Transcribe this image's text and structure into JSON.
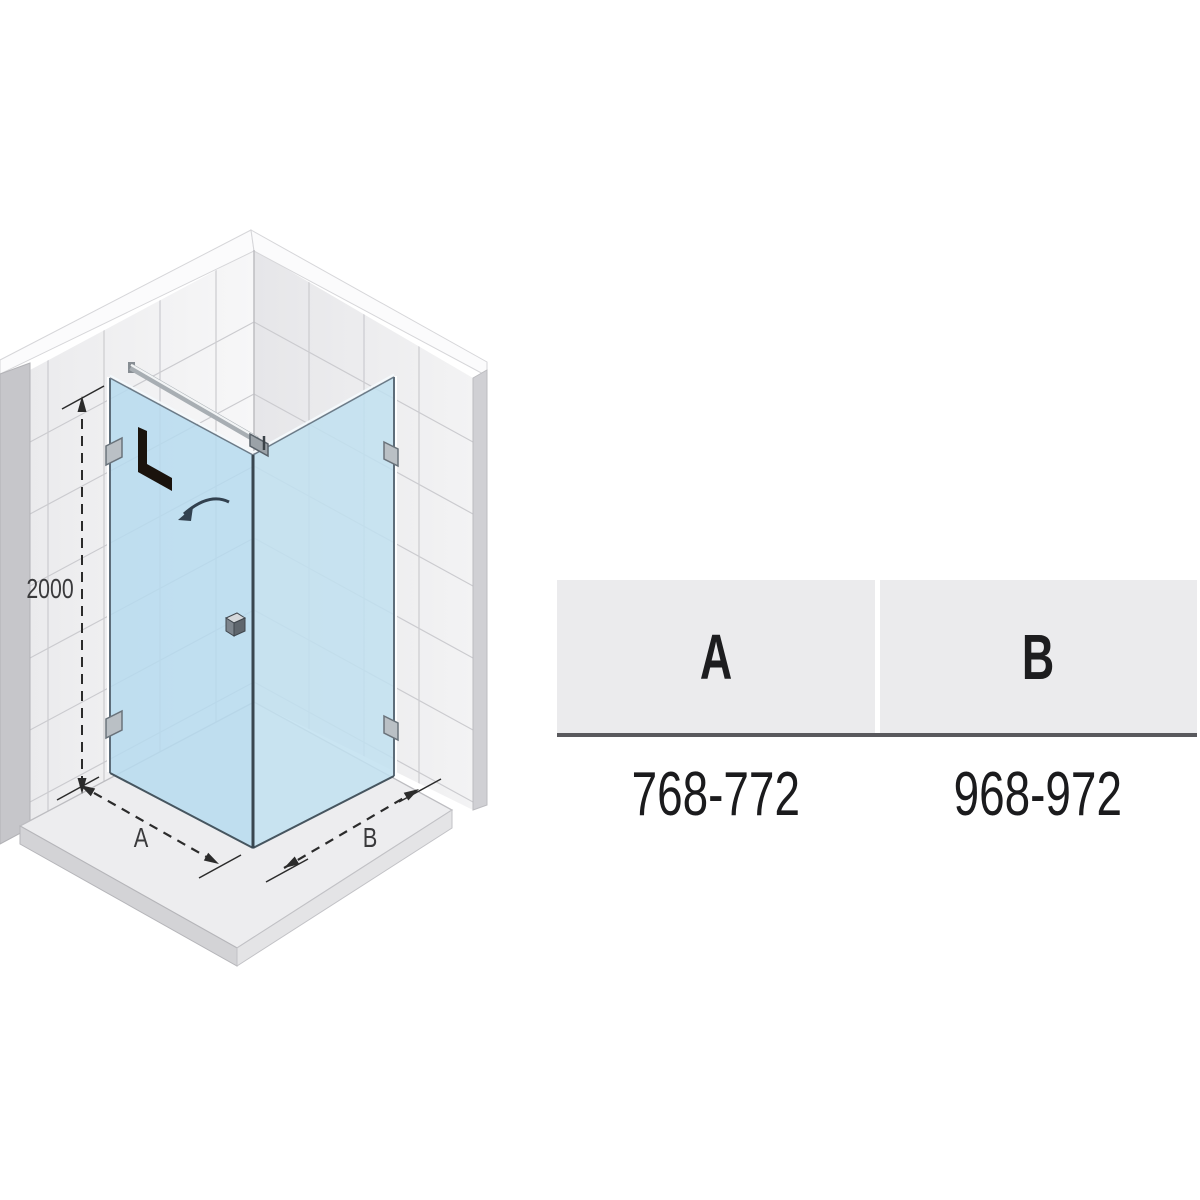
{
  "diagram": {
    "height_label": "2000",
    "side_a_label": "A",
    "side_b_label": "B",
    "door_orientation_label": "L"
  },
  "table": {
    "headers": [
      "A",
      "B"
    ],
    "rows": [
      [
        "768-772",
        "968-972"
      ]
    ]
  },
  "colors": {
    "glass_door": "#b6dbee",
    "glass_fixed_panel": "#c1e0f0",
    "table_header_bg": "#ebebed",
    "table_rule": "#59595d",
    "dimension_lines": "#2b2b2b",
    "wall_tile": "#f0f0f2",
    "tray": "#ededef"
  }
}
